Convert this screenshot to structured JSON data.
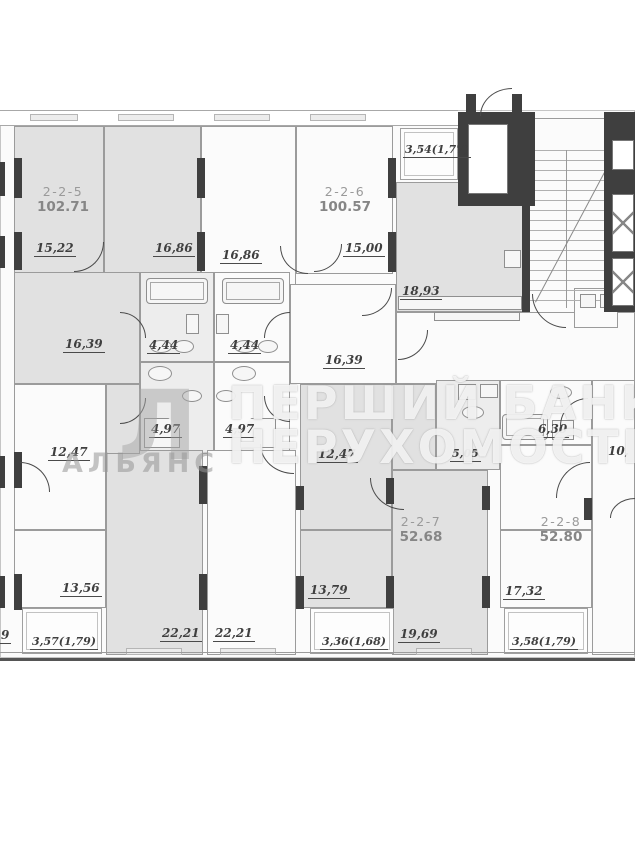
{
  "watermark": {
    "line1": "ПЕРШИЙ БАНК",
    "line2": "НЕРУХОМОСТІ",
    "brand": "АЛЬЯНС",
    "logo_letter": "Л"
  },
  "units": {
    "u225": {
      "id": "2-2-5",
      "total": "102.71"
    },
    "u226": {
      "id": "2-2-6",
      "total": "100.57"
    },
    "u227": {
      "id": "2-2-7",
      "total": "52.68"
    },
    "u228": {
      "id": "2-2-8",
      "total": "52.80"
    }
  },
  "rooms": {
    "r1522": "15,22",
    "r1686a": "16,86",
    "r1686b": "16,86",
    "r1500": "15,00",
    "balc354": "3,54(1,77)",
    "r1893": "18,93",
    "corr_a": "16,39",
    "corr_b": "16,39",
    "bath_a": "4,44",
    "bath_b": "4,44",
    "wc_a": "4,97",
    "wc_b": "4,97",
    "r1247a": "12,47",
    "r1247b": "12,47",
    "bath505": "5,05",
    "bath630": "6,30",
    "r10_partial": "10,",
    "r1356": "13,56",
    "r1379": "13,79",
    "r1732": "17,32",
    "r2221a": "22,21",
    "r2221b": "22,21",
    "r1969": "19,69",
    "balc357": "3,57(1,79)",
    "balc336": "3,36(1,68)",
    "balc358": "3,58(1,79)",
    "edge_partial": "9"
  }
}
